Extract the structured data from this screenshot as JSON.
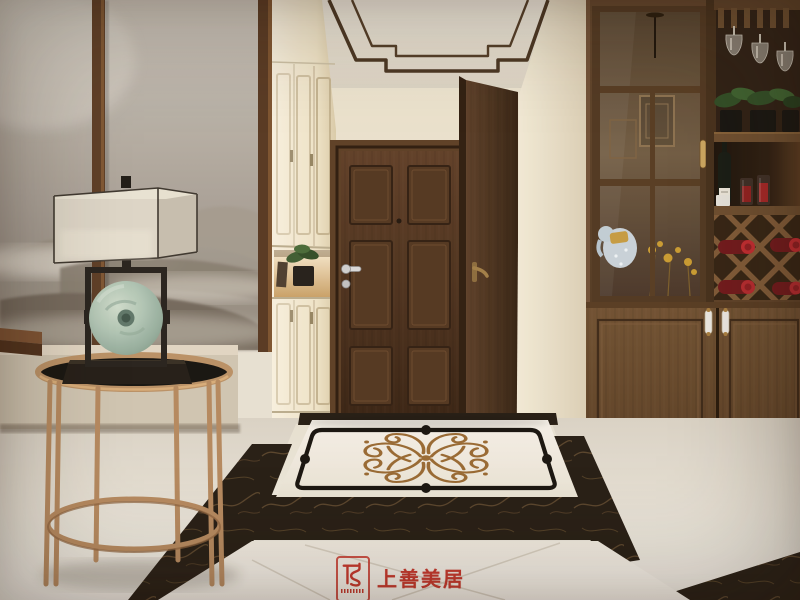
{
  "watermark": {
    "brand": "上善美居",
    "color": "#c63a2e",
    "icon": "shangshan-monogram-icon",
    "fineprint": "illegible fine print under monogram"
  },
  "scene": {
    "room": "entry-hallway",
    "style": "modern Chinese (new-Chinese) interior 3D rendering",
    "objects": [
      "ink-wash mountain mural wall",
      "dark walnut wall trim strips",
      "beige upholstered bench",
      "dark wood sideboard edge",
      "copper round side table with glass top",
      "table lamp with linen box shade and jade ring ornament",
      "white shoe cabinet with lit display niche, green plant and book",
      "walnut six-panel entry door with chrome lever and peephole",
      "secondary walnut door with brass lever",
      "walnut display cabinet: glass door with reflections (pendant lamp, elephant figurine, dried yellow flowers)",
      "hanging stemware rack with wine glasses",
      "potted green plants on cabinet shelf",
      "wine bottle and red-filled glasses in cubby",
      "X-lattice wine rack with red-capped bottles",
      "lower cabinet doors with white ceramic handles",
      "marble floor with cream tiles, black marble borders and bronze scroll medallion",
      "stepped dark ceiling trim"
    ],
    "palette": {
      "walnut": "#4a2e1a",
      "cream_wall": "#efe7d2",
      "copper": "#b3875c",
      "jade": "#9ab5a8",
      "dark_marble": "#221910",
      "bronze_ornament": "#96672f",
      "accent_red": "#c63a2e"
    }
  }
}
